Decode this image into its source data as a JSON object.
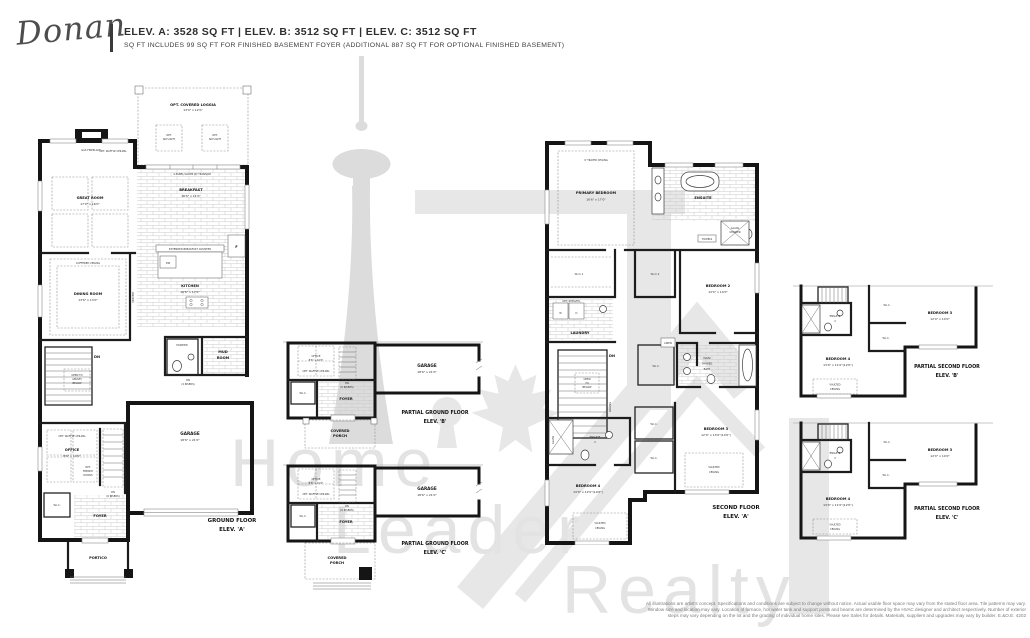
{
  "header": {
    "logo": "Donan",
    "elevations": "ELEV. A: 3528 SQ FT   |   ELEV. B: 3512 SQ FT   |   ELEV. C: 3512 SQ FT",
    "subtext": "SQ FT INCLUDES 99 SQ FT FOR FINISHED BASEMENT FOYER (ADDITIONAL 887 SQ FT FOR OPTIONAL FINISHED BASEMENT)"
  },
  "watermark": {
    "word1": "Home",
    "word2": "Leader",
    "word3": "Realty",
    "color": "#e3e3e3"
  },
  "common": {
    "wic": "W.I.C.",
    "foyer": "FOYER",
    "dn": "DN",
    "garage1": "GARAGE",
    "garage2": "18'6\" x 21'0\"",
    "office1": "OFFICE",
    "office2": "8'6\" x 10'0\"",
    "waffle": "OPT. WAFFLE CEILING",
    "french1": "OPT.",
    "french2": "FRENCH",
    "french3": "DOORS",
    "risers6": "(6 RISERS)",
    "porch1": "COVERED",
    "porch2": "PORCH",
    "railing": "RAILING"
  },
  "plans": {
    "ground_a": {
      "title1": "GROUND FLOOR",
      "title2": "ELEV. 'A'",
      "loggia1": "OPT. COVERED LOGGIA",
      "loggia2": "13'0\" x 12'0\"",
      "sky1": "OPT.",
      "sky2": "SKYLIGHT",
      "fireplace": "GAS FIREPLACE",
      "great1": "GREAT ROOM",
      "great2": "17'0\" x 16'0\"",
      "slider": "4-PANEL SLIDER W/ TRANSOM",
      "breakfast1": "BREAKFAST",
      "breakfast2": "16'6\" x 11'0\"",
      "counter": "EXTENDED BREAKFAST COUNTER",
      "dw": "DW",
      "fridge": "F",
      "kitchen1": "KITCHEN",
      "kitchen2": "16'6\" x 17'0\"",
      "coffered": "COFFERED CEILING",
      "dining1": "DINING ROOM",
      "dining2": "13'6\" x 13'0\"",
      "servery": "SERVERY",
      "powder": "POWDER",
      "mud1": "MUD",
      "mud2": "ROOM",
      "risers4": "(4 RISERS)",
      "open1": "OPEN TO",
      "open2": "ABOVE/",
      "open3": "BELOW",
      "portico": "PORTICO"
    },
    "ground_b": {
      "title1": "PARTIAL GROUND FLOOR",
      "title2": "ELEV. 'B'"
    },
    "ground_c": {
      "title1": "PARTIAL GROUND FLOOR",
      "title2": "ELEV. 'C'"
    },
    "second_a": {
      "title1": "SECOND FLOOR",
      "title2": "ELEV. 'A'",
      "tray": "9' TRAYED CEILING",
      "primary1": "PRIMARY BEDROOM",
      "primary2": "16'6\" x 17'0\"",
      "ensuite": "ENSUITE",
      "glass1": "GLASS",
      "glass2": "SHOWER",
      "towels": "TOWELS",
      "wic1": "W.I.C.1",
      "wic2": "W.I.C.2",
      "shelves": "OPT. SHELVES",
      "w": "W",
      "d": "D",
      "laundry": "LAUNDRY",
      "bed2_1": "BEDROOM 2",
      "bed2_2": "12'0\" x 14'0\"",
      "bath1": "MAIN/",
      "bath2": "SHARED",
      "bath3": "BATH",
      "linen": "LINEN",
      "open1": "OPEN",
      "open2": "TO",
      "open3": "BELOW",
      "bed3_1": "BEDROOM 3",
      "bed3_2": "12'0\" x 13'0\"(14'0\")",
      "ens2_1": "ENSUITE",
      "ens2_2": "2",
      "bed4_1": "BEDROOM 4",
      "bed4_2": "13'0\" x 12'0\"(10'0\")",
      "vault1": "VAULTED",
      "vault2": "CEILING"
    },
    "second_b": {
      "title1": "PARTIAL SECOND FLOOR",
      "title2": "ELEV. 'B'",
      "bed3_1": "BEDROOM 3",
      "bed3_2": "12'0\" x 14'0\"",
      "bed4_1": "BEDROOM 4",
      "bed4_2": "13'0\" x 11'0\"(12'0\")",
      "ens2_1": "ENSUITE",
      "ens2_2": "2",
      "vault1": "VAULTED",
      "vault2": "CEILING"
    },
    "second_c": {
      "title1": "PARTIAL SECOND FLOOR",
      "title2": "ELEV. 'C'"
    }
  },
  "disclaimer": {
    "lines": [
      "All illustrations are artist's concept. Specifications and conditions are subject to change without notice. Actual usable floor space may vary from the stated floor area. Tile patterns may vary.",
      "Window size and location may vary. Location of furnace, hot water tank and support posts and beams are determined by the HVAC designer and architect respectively. Number of exterior",
      "steps may vary depending on the lot and the grading of individual home sites. Please see Sales for details. Materials, suppliers and upgrades may vary by builder. E.&O.E. 4202"
    ]
  }
}
